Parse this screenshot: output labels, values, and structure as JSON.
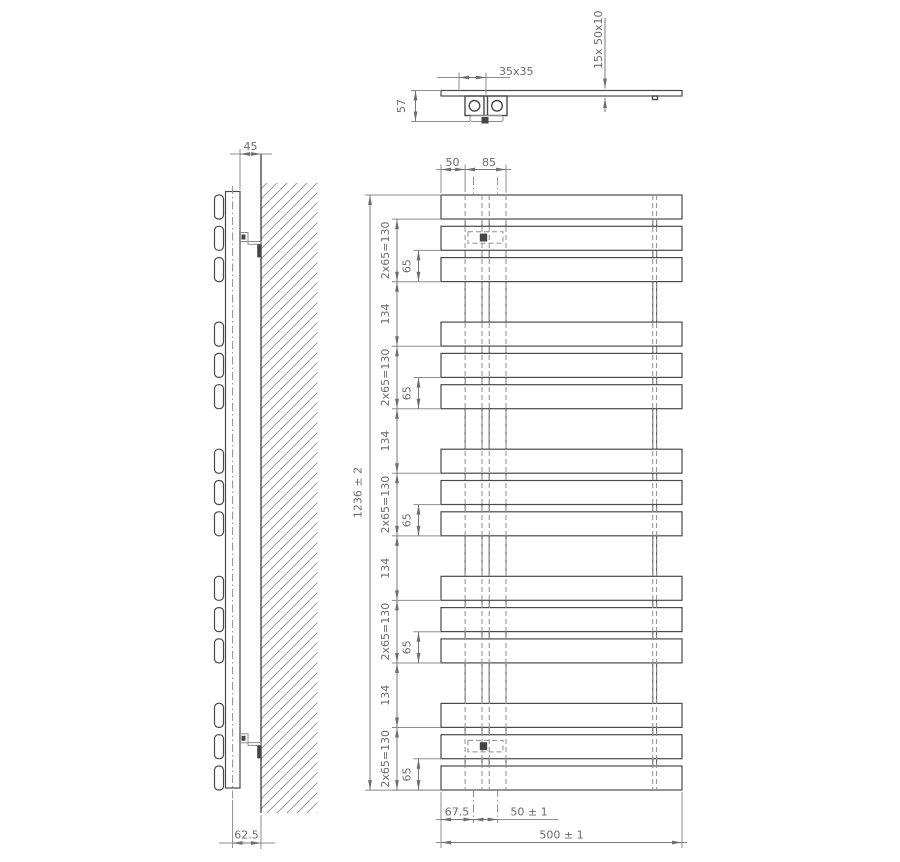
{
  "dims": {
    "top": {
      "tube_profile": "35x35",
      "depth": "57",
      "bars_spec": "15x  50x10"
    },
    "side": {
      "wall_clearance": "45",
      "axis_to_wall": "62.5"
    },
    "front": {
      "edge_to_tube": "50",
      "tube_outer": "85",
      "total_height": "1236 ± 2",
      "group_height": "2x65=130",
      "bar_pitch": "65",
      "group_gap": "134",
      "edge_to_axis": "67.5",
      "axis_spacing": "50 ± 1",
      "total_width": "500 ± 1"
    }
  }
}
